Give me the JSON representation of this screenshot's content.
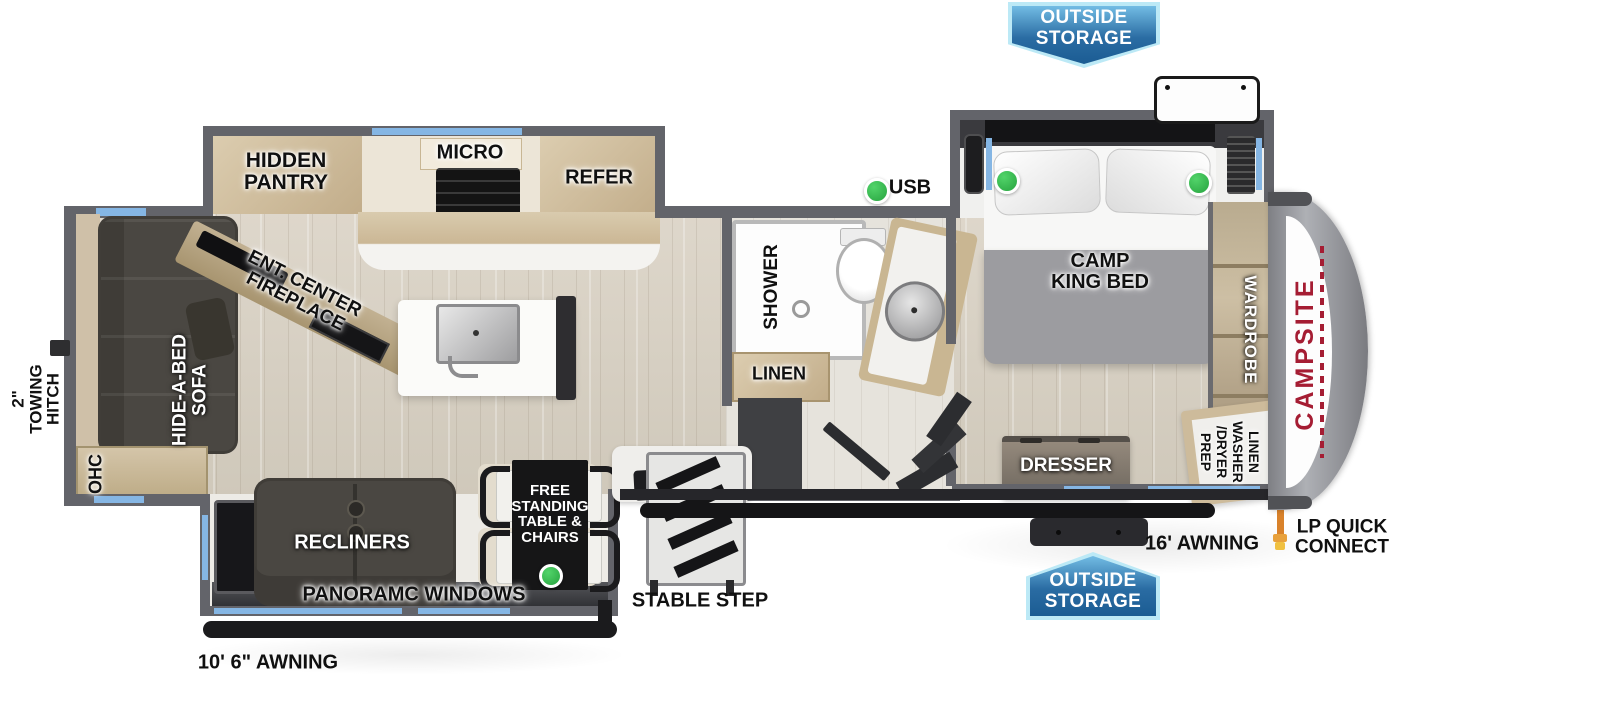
{
  "labels": {
    "outside_storage_top": [
      "OUTSIDE",
      "STORAGE"
    ],
    "outside_storage_bottom": [
      "OUTSIDE",
      "STORAGE"
    ],
    "hidden_pantry": [
      "HIDDEN",
      "PANTRY"
    ],
    "micro": "MICRO",
    "refer": "REFER",
    "usb": "USB",
    "ent_center": [
      "ENT. CENTER",
      "FIREPLACE"
    ],
    "hide_a_bed": [
      "HIDE-A-BED",
      "SOFA"
    ],
    "ohc": "OHC",
    "towing_hitch": [
      "2\"",
      "TOWING",
      "HITCH"
    ],
    "shower": "SHOWER",
    "linen": "LINEN",
    "camp_king_bed": [
      "CAMP",
      "KING BED"
    ],
    "wardrobe": "WARDROBE",
    "dresser": "DRESSER",
    "wd_prep": [
      "LINEN",
      "WASHER",
      "/DRYER",
      "PREP"
    ],
    "recliners": "RECLINERS",
    "free_standing_table": [
      "FREE",
      "STANDING",
      "TABLE &",
      "CHAIRS"
    ],
    "panoramic_windows": "PANORAMC WINDOWS",
    "awning_rear": "10' 6\" AWNING",
    "awning_front": "16' AWNING",
    "stable_step": "STABLE STEP",
    "lp_quick_connect": [
      "LP QUICK",
      "CONNECT"
    ],
    "brand": "CAMPSITE"
  },
  "colors": {
    "badge_blue": "#2a6ca3",
    "badge_border_light": "#bce9f6",
    "window_blue": "#85b6e4",
    "wall_gray": "#63646a",
    "brand_red": "#a51d33",
    "usb_indicator_green": "#2fae47",
    "lp_connect_orange": "#d9822b"
  }
}
